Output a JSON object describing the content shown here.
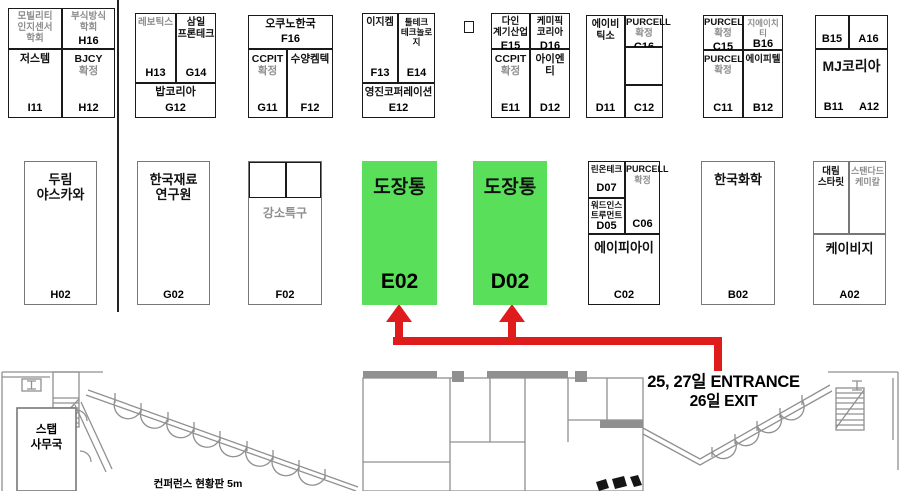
{
  "colors": {
    "highlight_green": "#5adf5a",
    "arrow_red": "#df1b1b",
    "gray_text": "#8e8e8e",
    "wall_gray": "#909090"
  },
  "entrance": {
    "line1": "25, 27일 ENTRANCE",
    "line2": "26일 EXIT"
  },
  "labels": {
    "conference_board": "컨퍼런스 현황판 5m",
    "staff_office_l1": "스탭",
    "staff_office_l2": "사무국"
  },
  "map": {
    "cells": [
      {
        "n": "booth-mobility-sensor-society",
        "x": 8,
        "y": 8,
        "w": 54,
        "h": 41,
        "fs": 9.5,
        "pt": 2,
        "ln": [
          {
            "t": "모빌리티",
            "g": true
          },
          {
            "t": "인지센서",
            "g": true
          },
          {
            "t": "학회",
            "g": true
          }
        ]
      },
      {
        "n": "booth-h16",
        "x": 62,
        "y": 8,
        "w": 53,
        "h": 41,
        "fs": 9.5,
        "pt": 2,
        "ln": [
          {
            "t": "부식방식",
            "g": true
          },
          {
            "t": "학회",
            "g": true
          }
        ],
        "code": "H16",
        "cp": "f"
      },
      {
        "n": "booth-i11",
        "x": 8,
        "y": 49,
        "w": 54,
        "h": 69,
        "fs": 11,
        "ln": [
          {
            "t": "저스템"
          }
        ],
        "code": "I11"
      },
      {
        "n": "booth-h12",
        "x": 62,
        "y": 49,
        "w": 53,
        "h": 69,
        "fs": 10.5,
        "ln": [
          {
            "t": "BJCY"
          },
          {
            "t": "확정",
            "g": true
          }
        ],
        "code": "H12"
      },
      {
        "n": "booth-h13",
        "x": 135,
        "y": 13,
        "w": 41,
        "h": 70,
        "fs": 9.5,
        "ln": [
          {
            "t": "레보틱스",
            "g": true
          }
        ],
        "code": "H13"
      },
      {
        "n": "booth-g14",
        "x": 176,
        "y": 13,
        "w": 40,
        "h": 70,
        "fs": 10,
        "ln": [
          {
            "t": "삼일"
          },
          {
            "t": "프론테크"
          }
        ],
        "code": "G14"
      },
      {
        "n": "booth-g12",
        "x": 135,
        "y": 83,
        "w": 81,
        "h": 35,
        "fs": 11,
        "pt": 2,
        "ln": [
          {
            "t": "밥코리아"
          }
        ],
        "code": "G12"
      },
      {
        "n": "booth-f16",
        "x": 248,
        "y": 15,
        "w": 85,
        "h": 34,
        "fs": 11,
        "pt": 2,
        "ln": [
          {
            "t": "오쿠노한국"
          }
        ],
        "code": "F16"
      },
      {
        "n": "booth-g11",
        "x": 248,
        "y": 49,
        "w": 39,
        "h": 69,
        "fs": 10.5,
        "ln": [
          {
            "t": "CCPIT"
          },
          {
            "t": "확정",
            "g": true
          }
        ],
        "code": "G11"
      },
      {
        "n": "booth-f12",
        "x": 287,
        "y": 49,
        "w": 46,
        "h": 69,
        "fs": 10.5,
        "ln": [
          {
            "t": "수양켐텍"
          }
        ],
        "code": "F12"
      },
      {
        "n": "booth-f13",
        "x": 362,
        "y": 13,
        "w": 36,
        "h": 70,
        "fs": 10,
        "ln": [
          {
            "t": "이지켐"
          }
        ],
        "code": "F13"
      },
      {
        "n": "booth-e14",
        "x": 398,
        "y": 13,
        "w": 37,
        "h": 70,
        "fs": 8.5,
        "ln": [
          {
            "t": "툴테크"
          },
          {
            "t": "테크놀로지"
          }
        ],
        "code": "E14"
      },
      {
        "n": "booth-e12",
        "x": 362,
        "y": 83,
        "w": 73,
        "h": 35,
        "fs": 10.5,
        "pt": 2,
        "ln": [
          {
            "t": "영진코퍼레이션"
          }
        ],
        "code": "E12"
      },
      {
        "n": "small-booth-marker",
        "x": 464,
        "y": 21,
        "w": 10,
        "h": 12
      },
      {
        "n": "booth-e15",
        "x": 491,
        "y": 13,
        "w": 39,
        "h": 36,
        "fs": 9.5,
        "pt": 2,
        "ln": [
          {
            "t": "다인"
          },
          {
            "t": "계기산업"
          }
        ],
        "code": "E15",
        "cp": "f"
      },
      {
        "n": "booth-d16",
        "x": 530,
        "y": 13,
        "w": 40,
        "h": 36,
        "fs": 9.5,
        "pt": 2,
        "ln": [
          {
            "t": "케미픽"
          },
          {
            "t": "코리아"
          }
        ],
        "code": "D16",
        "cp": "f"
      },
      {
        "n": "booth-e11",
        "x": 491,
        "y": 49,
        "w": 39,
        "h": 69,
        "fs": 10.5,
        "ln": [
          {
            "t": "CCPIT"
          },
          {
            "t": "확정",
            "g": true
          }
        ],
        "code": "E11"
      },
      {
        "n": "booth-d12",
        "x": 530,
        "y": 49,
        "w": 40,
        "h": 69,
        "fs": 10.5,
        "ln": [
          {
            "t": "아이엔티"
          }
        ],
        "code": "D12"
      },
      {
        "n": "booth-d11",
        "x": 586,
        "y": 15,
        "w": 39,
        "h": 103,
        "fs": 10,
        "ln": [
          {
            "t": "에이비"
          },
          {
            "t": "틱소"
          }
        ],
        "code": "D11"
      },
      {
        "n": "booth-c16",
        "x": 625,
        "y": 15,
        "w": 38,
        "h": 32,
        "fs": 9.5,
        "pt": 1,
        "ln": [
          {
            "t": "PURCELL"
          },
          {
            "t": "확정",
            "g": true
          }
        ],
        "code": "C16",
        "cp": "f"
      },
      {
        "n": "booth-empty-mid",
        "x": 625,
        "y": 47,
        "w": 38,
        "h": 38
      },
      {
        "n": "booth-c12",
        "x": 625,
        "y": 85,
        "w": 38,
        "h": 33,
        "code": "C12"
      },
      {
        "n": "booth-c15",
        "x": 703,
        "y": 15,
        "w": 40,
        "h": 35,
        "fs": 9.5,
        "pt": 1,
        "ln": [
          {
            "t": "PURCELL"
          },
          {
            "t": "확정",
            "g": true
          }
        ],
        "code": "C15",
        "cp": "f"
      },
      {
        "n": "booth-b16",
        "x": 743,
        "y": 15,
        "w": 40,
        "h": 35,
        "fs": 8.5,
        "pt": 2,
        "ln": [
          {
            "t": "지에이치티",
            "g": true
          }
        ],
        "code": "B16"
      },
      {
        "n": "booth-c11",
        "x": 703,
        "y": 50,
        "w": 40,
        "h": 68,
        "fs": 9.5,
        "ln": [
          {
            "t": "PURCELL"
          },
          {
            "t": "확정",
            "g": true
          }
        ],
        "code": "C11"
      },
      {
        "n": "booth-b12",
        "x": 743,
        "y": 50,
        "w": 40,
        "h": 68,
        "fs": 9.5,
        "ln": [
          {
            "t": "에이피텔"
          }
        ],
        "code": "B12"
      },
      {
        "n": "booth-b15",
        "x": 815,
        "y": 15,
        "w": 34,
        "h": 34,
        "code": "B15"
      },
      {
        "n": "booth-a16",
        "x": 849,
        "y": 15,
        "w": 39,
        "h": 34,
        "code": "A16"
      },
      {
        "n": "booth-mj-korea",
        "x": 815,
        "y": 49,
        "w": 73,
        "h": 69,
        "fs": 14,
        "pt": 8,
        "ln": [
          {
            "t": "MJ코리아"
          }
        ],
        "codes": [
          "B11",
          "A12"
        ]
      },
      {
        "n": "booth-h02",
        "x": 24,
        "y": 161,
        "w": 73,
        "h": 144,
        "b": "mid",
        "fs": 13,
        "pt": 10,
        "ln": [
          {
            "t": "두림"
          },
          {
            "t": "야스카와"
          }
        ],
        "code": "H02"
      },
      {
        "n": "booth-g02",
        "x": 137,
        "y": 161,
        "w": 73,
        "h": 144,
        "b": "mid",
        "fs": 13,
        "pt": 10,
        "ln": [
          {
            "t": "한국재료"
          },
          {
            "t": "연구원"
          }
        ],
        "code": "G02"
      },
      {
        "n": "booth-f02",
        "x": 248,
        "y": 161,
        "w": 74,
        "h": 144,
        "b": "mid",
        "fs": 12,
        "pt": 44,
        "ln": [
          {
            "t": "강소특구",
            "g": true
          }
        ],
        "code": "F02"
      },
      {
        "n": "booth-f02-subbox-1",
        "x": 249,
        "y": 162,
        "w": 37,
        "h": 36
      },
      {
        "n": "booth-f02-subbox-2",
        "x": 286,
        "y": 162,
        "w": 35,
        "h": 36
      },
      {
        "n": "booth-e02-highlight",
        "x": 362,
        "y": 161,
        "w": 75,
        "h": 144,
        "b": "none",
        "bg": "green",
        "fs": 19,
        "cfs": 21,
        "pt": 16,
        "pb": 12,
        "ln": [
          {
            "t": "도장통"
          }
        ],
        "code": "E02"
      },
      {
        "n": "booth-d02-highlight",
        "x": 473,
        "y": 161,
        "w": 74,
        "h": 144,
        "b": "none",
        "bg": "green",
        "fs": 19,
        "cfs": 21,
        "pt": 16,
        "pb": 12,
        "ln": [
          {
            "t": "도장통"
          }
        ],
        "code": "D02"
      },
      {
        "n": "booth-d07",
        "x": 588,
        "y": 161,
        "w": 37,
        "h": 37,
        "fs": 8.5,
        "pt": 2,
        "ln": [
          {
            "t": "린온테크"
          }
        ],
        "code": "D07"
      },
      {
        "n": "booth-d05",
        "x": 588,
        "y": 198,
        "w": 37,
        "h": 36,
        "fs": 8.5,
        "pt": 1,
        "ln": [
          {
            "t": "워드인스"
          },
          {
            "t": "트루먼트"
          }
        ],
        "code": "D05"
      },
      {
        "n": "booth-c06",
        "x": 625,
        "y": 161,
        "w": 35,
        "h": 73,
        "fs": 9,
        "pt": 2,
        "ln": [
          {
            "t": "PURCELL"
          },
          {
            "t": "확정",
            "g": true
          }
        ],
        "code": "C06"
      },
      {
        "n": "booth-api",
        "x": 588,
        "y": 234,
        "w": 72,
        "h": 71,
        "fs": 13,
        "pt": 5,
        "ln": [
          {
            "t": "에이피아이"
          }
        ],
        "code": "C02"
      },
      {
        "n": "booth-b02",
        "x": 701,
        "y": 161,
        "w": 74,
        "h": 144,
        "b": "mid",
        "fs": 13,
        "pt": 10,
        "ln": [
          {
            "t": "한국화학"
          }
        ],
        "code": "B02"
      },
      {
        "n": "booth-daelim-starlet",
        "x": 813,
        "y": 161,
        "w": 36,
        "h": 73,
        "b": "mid",
        "fs": 9.5,
        "pt": 4,
        "ln": [
          {
            "t": "대림"
          },
          {
            "t": "스타릿"
          }
        ]
      },
      {
        "n": "booth-standard-chemical",
        "x": 849,
        "y": 161,
        "w": 37,
        "h": 73,
        "b": "mid",
        "fs": 9,
        "pt": 4,
        "ln": [
          {
            "t": "스탠다드",
            "g": true
          },
          {
            "t": "케미칼",
            "g": true
          }
        ]
      },
      {
        "n": "booth-kbg",
        "x": 813,
        "y": 234,
        "w": 73,
        "h": 71,
        "b": "mid",
        "fs": 13,
        "pt": 6,
        "ln": [
          {
            "t": "케이비지"
          }
        ],
        "code": "A02"
      }
    ]
  }
}
